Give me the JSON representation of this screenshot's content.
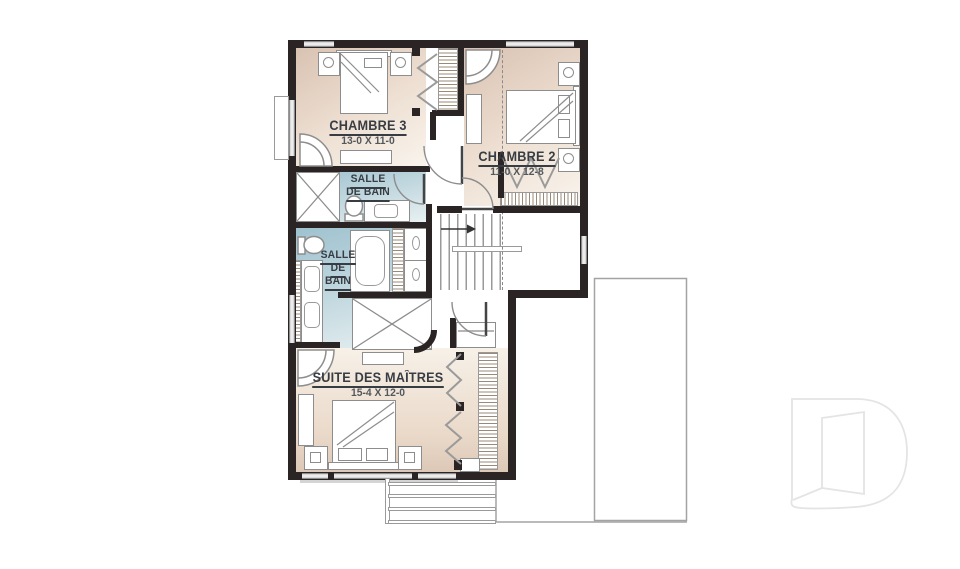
{
  "plan": {
    "type": "floor-plan-upper-level",
    "rooms": {
      "chambre3": {
        "name": "CHAMBRE 3",
        "dims": "13-0 X 11-0"
      },
      "chambre2": {
        "name": "CHAMBRE 2",
        "dims": "11-0 X 12-8"
      },
      "bain1": {
        "line1": "SALLE",
        "line2": "DE BAIN"
      },
      "bain2": {
        "line1": "SALLE",
        "line2": "DE",
        "line3": "BAIN"
      },
      "suite": {
        "name": "SUITE DES MAÎTRES",
        "dims": "15-4 X 12-0"
      }
    },
    "colors": {
      "wall": "#2a2424",
      "floor_beige": "#dcc6b6",
      "floor_beige_light": "#f7f1e9",
      "bath_blue": "#a0c4d0",
      "bath_blue_light": "#e7f0f2",
      "label_text": "#383d43",
      "dim_text": "#53585d",
      "outline_gray": "#8d8d8d",
      "watermark_gray": "#e4e4e4"
    },
    "branding": {
      "watermark_letter": "D"
    }
  }
}
